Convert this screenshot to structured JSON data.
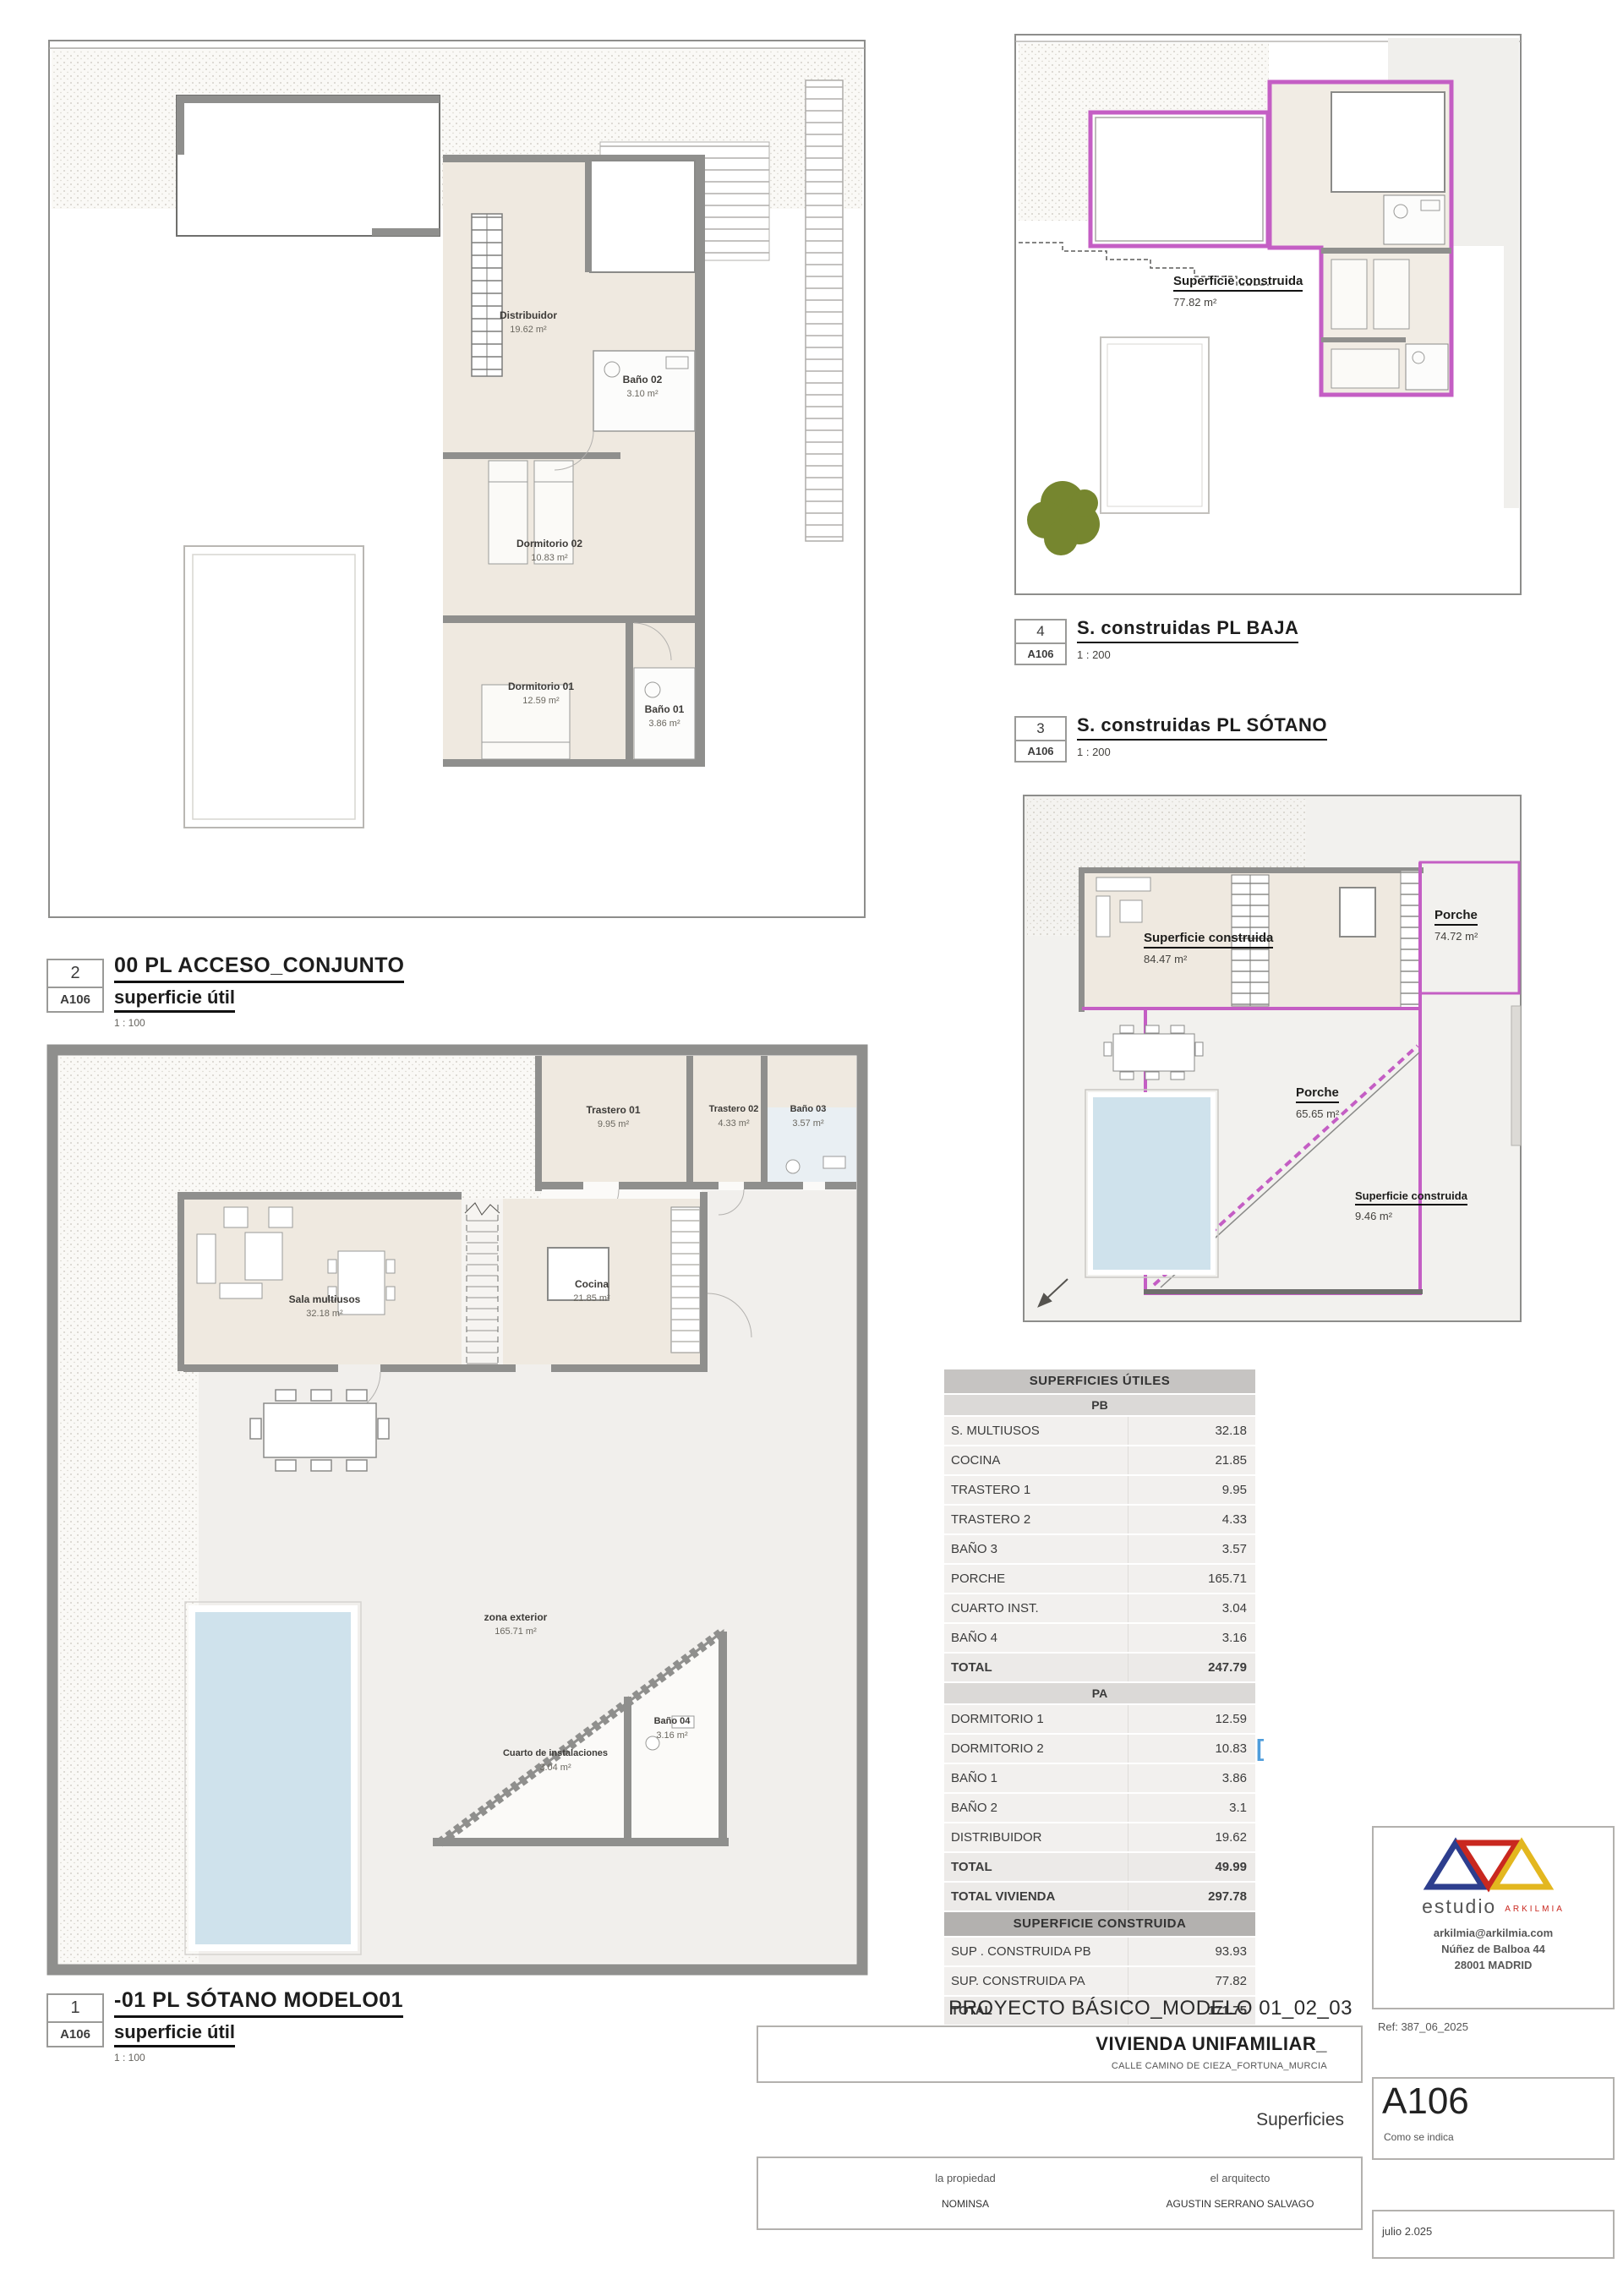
{
  "captions": {
    "acceso": {
      "number": "2",
      "sheet": "A106",
      "title": "00 PL ACCESO_CONJUNTO",
      "subtitle": "superficie útil",
      "scale": "1 : 100"
    },
    "baja": {
      "number": "4",
      "sheet": "A106",
      "title": "S. construidas PL BAJA",
      "scale": "1 : 200"
    },
    "sotano_constr": {
      "number": "3",
      "sheet": "A106",
      "title": "S. construidas PL SÓTANO",
      "scale": "1 : 200"
    },
    "sotano": {
      "number": "1",
      "sheet": "A106",
      "title": "-01 PL SÓTANO MODELO01",
      "subtitle": "superficie útil",
      "scale": "1 : 100"
    }
  },
  "plan_acceso": {
    "rooms": {
      "distribuidor": {
        "name": "Distribuidor",
        "area": "19.62 m²"
      },
      "bano02": {
        "name": "Baño 02",
        "area": "3.10 m²"
      },
      "dormitorio02": {
        "name": "Dormitorio 02",
        "area": "10.83 m²"
      },
      "dormitorio01": {
        "name": "Dormitorio 01",
        "area": "12.59 m²"
      },
      "bano01": {
        "name": "Baño 01",
        "area": "3.86 m²"
      }
    }
  },
  "plan_baja": {
    "labels": {
      "construida": {
        "name": "Superficie construida",
        "area": "77.82 m²"
      }
    }
  },
  "plan_sconst": {
    "labels": {
      "construida84": {
        "name": "Superficie construida",
        "area": "84.47 m²"
      },
      "porche74": {
        "name": "Porche",
        "area": "74.72 m²"
      },
      "porche65": {
        "name": "Porche",
        "area": "65.65 m²"
      },
      "construida9": {
        "name": "Superficie construida",
        "area": "9.46 m²"
      }
    }
  },
  "plan_sotano": {
    "rooms": {
      "trastero01": {
        "name": "Trastero 01",
        "area": "9.95 m²"
      },
      "trastero02": {
        "name": "Trastero 02",
        "area": "4.33 m²"
      },
      "bano03": {
        "name": "Baño 03",
        "area": "3.57 m²"
      },
      "sala": {
        "name": "Sala multiusos",
        "area": "32.18 m²"
      },
      "cocina": {
        "name": "Cocina",
        "area": "21.85 m²"
      },
      "zona": {
        "name": "zona exterior",
        "area": "165.71 m²"
      },
      "cuarto": {
        "name": "Cuarto de instalaciones",
        "area": "3.04 m²"
      },
      "bano04": {
        "name": "Baño 04",
        "area": "3.16 m²"
      }
    }
  },
  "table": {
    "title": "SUPERFICIES ÚTILES",
    "pb": {
      "header": "PB",
      "rows": [
        [
          "S. MULTIUSOS",
          "32.18"
        ],
        [
          "COCINA",
          "21.85"
        ],
        [
          "TRASTERO 1",
          "9.95"
        ],
        [
          "TRASTERO 2",
          "4.33"
        ],
        [
          "BAÑO 3",
          "3.57"
        ],
        [
          "PORCHE",
          "165.71"
        ],
        [
          "CUARTO INST.",
          "3.04"
        ],
        [
          "BAÑO 4",
          "3.16"
        ]
      ],
      "total": [
        "TOTAL",
        "247.79"
      ]
    },
    "pa": {
      "header": "PA",
      "rows": [
        [
          "DORMITORIO 1",
          "12.59"
        ],
        [
          "DORMITORIO 2",
          "10.83"
        ],
        [
          "BAÑO 1",
          "3.86"
        ],
        [
          "BAÑO 2",
          "3.1"
        ],
        [
          "DISTRIBUIDOR",
          "19.62"
        ]
      ],
      "total": [
        "TOTAL",
        "49.99"
      ]
    },
    "total_vivienda": [
      "TOTAL VIVIENDA",
      "297.78"
    ],
    "construida": {
      "header": "SUPERFICIE CONSTRUIDA",
      "rows": [
        [
          "SUP . CONSTRUIDA PB",
          "93.93"
        ],
        [
          "SUP. CONSTRUIDA PA",
          "77.82"
        ]
      ],
      "total": [
        "TOTAL",
        "171.75"
      ]
    },
    "cursor_artifact": "["
  },
  "titleblock": {
    "project": "PROYECTO BÁSICO_MODELO 01_02_03",
    "building": "VIVIENDA UNIFAMILIAR_",
    "address": "CALLE CAMINO DE CIEZA_FORTUNA_MURCIA",
    "sheet_name": "Superficies",
    "sheet_number": "A106",
    "scale_note": "Como se indica",
    "owner_label": "la propiedad",
    "owner": "NOMINSA",
    "architect_label": "el arquitecto",
    "architect": "AGUSTIN SERRANO SALVAGO",
    "date": "julio 2.025",
    "ref": "Ref: 387_06_2025",
    "studio_name": "estudio",
    "studio_brand": "ARKILMIA",
    "studio_email": "arkilmia@arkilmia.com",
    "studio_address1": "Núñez de Balboa 44",
    "studio_address2": "28001 MADRID"
  },
  "colors": {
    "magenta": "#c45ec4",
    "wall_gray": "#8f8f8d",
    "floor_beige": "#efe9e0",
    "pool_blue": "#cfe2ec",
    "tree_green": "#76862f",
    "logo_blue": "#2d3e8e",
    "logo_red": "#c9281f",
    "logo_yellow": "#e3b71f"
  }
}
